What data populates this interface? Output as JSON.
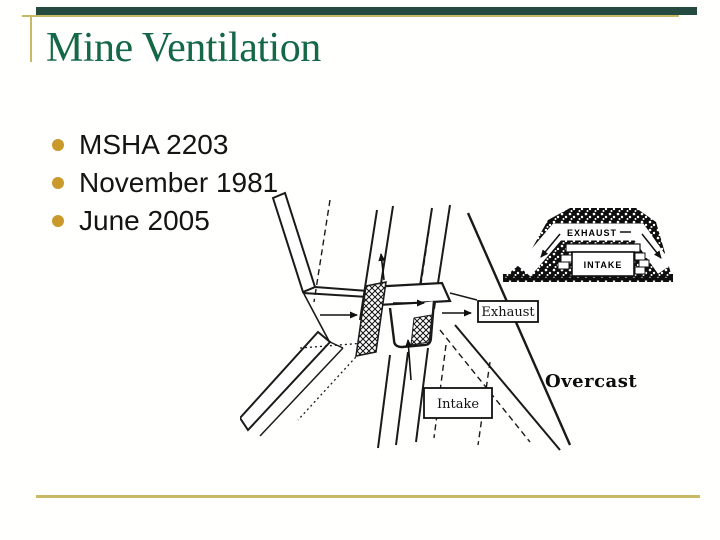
{
  "slide": {
    "title": "Mine Ventilation",
    "bullets": [
      "MSHA 2203",
      "November 1981",
      "June 2005"
    ],
    "colors": {
      "title_green": "#156845",
      "top_bar_teal": "#254b41",
      "rule_gold": "#c8b967",
      "bullet_gold": "#c9992b",
      "ink": "#141414",
      "background": "#fffffd"
    }
  },
  "diagram": {
    "exhaust_box_label": "Exhaust",
    "intake_box_label": "Intake",
    "overcast_label": "Overcast",
    "inset": {
      "exhaust_label": "EXHAUST",
      "intake_label": "INTAKE"
    }
  }
}
